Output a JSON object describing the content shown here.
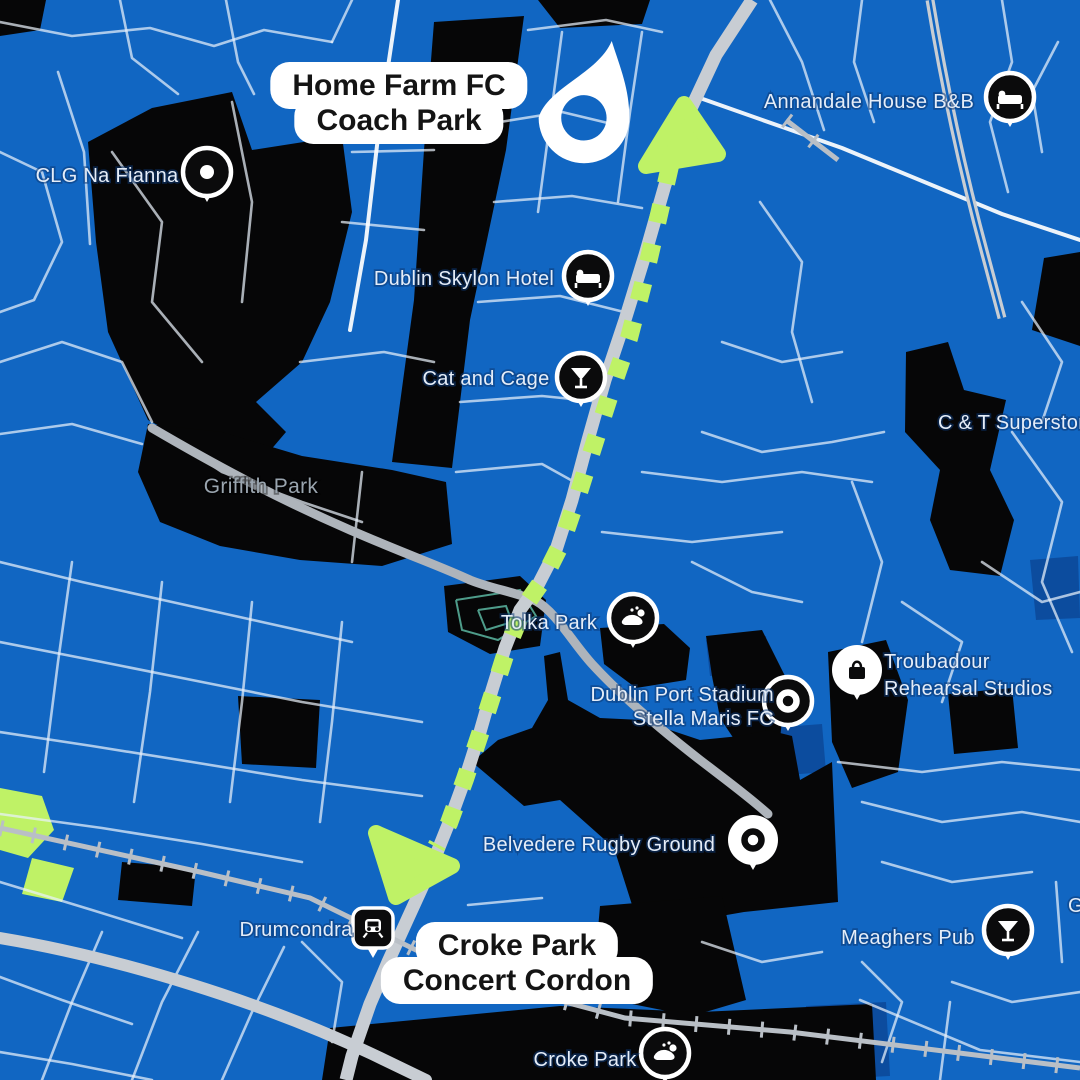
{
  "title": "Croke Park concert coach route map",
  "colors": {
    "background": "#1166C2",
    "land_black": "#060607",
    "building_navy": "#0C4C9E",
    "road_minor": "#E9F1FB",
    "road_major": "#C8CDD3",
    "river": "#AEB4BB",
    "railway": "#B9BFC6",
    "route_green": "#BFF266",
    "pitch_teal": "#4E9C8A",
    "poi_text": "#E5EDF8",
    "park_text": "#9AA5AF",
    "pill_background": "#FFFFFF",
    "pill_text": "#141414",
    "pin_dark": "#0B0B0C",
    "pin_ring": "#FFFFFF"
  },
  "overlays": {
    "start": {
      "line1": "Home Farm FC",
      "line2": "Coach Park"
    },
    "end": {
      "line1": "Croke Park",
      "line2": "Concert Cordon"
    },
    "drop_pin": "location-drop-pin"
  },
  "map": {
    "black_areas": [
      "0,0 46,0 40,30 0,36",
      "88,142 152,108 232,92 252,150 342,136 352,212 330,302 302,362 256,402 286,432 252,472 190,442 148,420 108,332 96,242",
      "148,424 222,432 302,456 392,470 446,482 452,544 382,566 300,560 220,546 160,522 138,472",
      "434,22 524,16 506,150 470,320 452,468 392,462 414,300 424,150",
      "538,0 650,0 642,24 560,28",
      "906,352 948,342 964,390 1006,400 990,470 1014,520 1000,576 950,570 930,520 940,470 905,432",
      "1044,258 1080,252 1080,346 1032,330",
      "444,586 520,576 546,600 540,646 490,654 448,632",
      "600,628 664,624 690,648 686,680 636,688 604,664",
      "706,636 762,630 786,678 780,740 748,760 720,718 712,676",
      "544,656 560,652 568,700 600,718 640,720 700,740 740,736 768,730 792,736 800,780 832,762 838,902 744,912 640,930 614,848 560,800 524,806 472,762 498,740 532,728 548,700",
      "600,906 722,896 746,1000 692,1016 622,1002 596,952",
      "330,1028 560,1006 700,1012 872,1004 876,1080 322,1080",
      "828,652 886,640 908,700 898,772 852,788 832,742",
      "122,862 196,868 192,906 118,900",
      "238,696 320,700 316,768 242,764",
      "948,694 1012,688 1018,748 954,754"
    ],
    "navy_buildings": [
      "770,728 822,724 826,772 774,776",
      "706,640 766,636 770,672 710,676",
      "806,1006 886,1002 890,1076 810,1080",
      "1030,560 1078,556 1080,618 1036,620"
    ],
    "green_patches": [
      "0,788 42,796 54,830 28,858 0,850",
      "32,858 74,868 62,902 22,894"
    ],
    "tolka_outline": [
      "456,600 520,590 536,616 498,640 462,630 456,600",
      "478,610 506,606 512,622 486,630 478,610"
    ],
    "minor_roads": [
      "0,22 72,36 150,28 214,46 264,30 332,42",
      "120,0 132,58 178,94",
      "226,0 238,62 254,94",
      "58,72 84,152 90,244",
      "0,152 42,172 62,242 34,300 0,312",
      "0,362 62,342 122,362 152,422",
      "0,434 72,424 142,444",
      "332,42 352,0",
      "352,152 434,150",
      "342,222 424,230",
      "300,362 384,352 434,362",
      "528,30 606,20 662,32",
      "500,122 562,112 612,124",
      "494,202 572,196 642,208",
      "478,302 560,296 624,312",
      "460,402 542,396 602,402",
      "562,32 550,122 538,212",
      "642,32 630,112 618,202",
      "456,472 542,464 578,484",
      "770,0 802,62 824,130",
      "862,0 854,62 874,122",
      "1002,0 1012,62 990,122 1008,192",
      "760,202 802,262 792,332 812,402",
      "1022,302 1062,362 1042,422",
      "722,342 782,362 842,352",
      "702,432 762,452 832,442 884,432",
      "1058,42 1032,92 1042,152",
      "642,472 722,482 802,472 872,482",
      "602,532 692,542 782,532",
      "852,482 882,562 862,642",
      "1012,432 1062,502 1042,582 1072,652",
      "902,602 962,642 942,702",
      "982,562 1042,602 1080,592",
      "692,562 752,592 802,602",
      "0,562 82,582 172,602 262,622 352,642",
      "0,642 102,662 202,682 302,702 422,722",
      "0,732 92,746 192,762 302,780 422,796",
      "0,814 102,828 202,844 302,862",
      "72,562 58,662 44,772",
      "162,582 150,692 134,802",
      "252,602 242,702 230,802",
      "342,622 332,722 320,822",
      "0,882 92,910 182,938",
      "42,1080 72,1002 102,932",
      "132,1080 162,1002 198,932",
      "222,1080 252,1012 284,947",
      "0,977 62,1000 132,1024",
      "0,1052 72,1064 152,1080",
      "302,942 342,982 332,1042",
      "838,762 922,772 1002,762 1080,770",
      "862,802 942,822 1022,812 1080,822",
      "882,862 952,882 1032,872",
      "1056,882 1062,962",
      "702,942 762,962 822,952",
      "862,962 902,1002 882,1062",
      "952,982 1012,1002 1080,992",
      "860,1000 980,1050 1080,1062",
      "950,1002 940,1080",
      "112,152 162,222 152,302 202,362",
      "232,102 252,202 242,302",
      "162,432 222,472 302,502 362,522",
      "362,472 352,562",
      "468,905 542,898"
    ],
    "bright_roads": [
      "700,98 842,148 1002,214 1080,240",
      "398,0 380,120 366,240 350,330"
    ],
    "major_road": "M752,0 L716,55 L688,115 L665,185 L645,255 L625,320 L605,380 L588,440 L572,500 L556,550 L538,585 L520,610 L505,648 L492,690 L480,732 L466,776 L450,820 L430,870 L408,918 L388,962 L370,1004 L352,1056 L346,1080",
    "motorway": "M930,0 C944,84 962,170 986,258 L1002,318",
    "belt_road": "M0,938 C120,958 262,1002 372,1054 L426,1080",
    "river": "M152,428 C210,462 272,496 350,530 C410,556 440,566 470,580 C492,589 516,592 536,601 C556,612 572,642 592,664 C614,688 646,718 700,760 C726,780 748,796 768,814",
    "railways": [
      "M0,828 L200,872 L310,898 L420,952 L520,990 L625,1018 L790,1032 L1080,1068",
      "M786,120 L838,160"
    ],
    "route": {
      "path": "M670,166 L656,228 L643,284 L629,338 L612,388 L596,438 L579,492 L562,542 L543,580 L524,607 L508,646 L494,690 L480,734 L465,779 L449,823 L436,847",
      "arrow_top": "M684,104 L646,166 L718,154 Z",
      "arrow_bottom": "M396,897 L376,833 L452,866 Z"
    },
    "pois": [
      {
        "id": "annandale-house-bb",
        "label": "Annandale House B&B",
        "anchor": "middle",
        "tx": 869,
        "ty": 108,
        "px": 1010,
        "py": 97,
        "icon": "bed",
        "style": "dark"
      },
      {
        "id": "clg-na-fianna",
        "label": "CLG Na Fianna",
        "anchor": "middle",
        "tx": 107,
        "ty": 182,
        "px": 207,
        "py": 172,
        "icon": "dot",
        "style": "dark"
      },
      {
        "id": "dublin-skylon-hotel",
        "label": "Dublin Skylon Hotel",
        "anchor": "middle",
        "tx": 464,
        "ty": 285,
        "px": 588,
        "py": 276,
        "icon": "bed",
        "style": "dark"
      },
      {
        "id": "cat-and-cage",
        "label": "Cat and Cage",
        "anchor": "middle",
        "tx": 486,
        "ty": 385,
        "px": 581,
        "py": 377,
        "icon": "martini",
        "style": "dark"
      },
      {
        "id": "griffith-park",
        "label": "Griffith Park",
        "anchor": "middle",
        "tx": 261,
        "ty": 493,
        "park": true
      },
      {
        "id": "c-and-t-superstore",
        "label": "C & T Superstore",
        "anchor": "start",
        "tx": 938,
        "ty": 429
      },
      {
        "id": "tolka-park",
        "label": "Tolka Park",
        "anchor": "middle",
        "tx": 549,
        "ty": 629,
        "px": 633,
        "py": 618,
        "icon": "stadium",
        "style": "dark"
      },
      {
        "id": "dublin-port-stadium",
        "label": "Dublin Port Stadium",
        "label2": "Stella Maris FC",
        "anchor": "end",
        "tx": 774,
        "ty": 701,
        "ty2": 725,
        "px": 788,
        "py": 701,
        "icon": "donut",
        "style": "dark"
      },
      {
        "id": "troubadour-rehearsal-studios",
        "label": "Troubadour",
        "label2": "Rehearsal Studios",
        "anchor": "start",
        "tx": 884,
        "ty": 668,
        "ty2": 695,
        "px": 857,
        "py": 670,
        "icon": "bag",
        "style": "light"
      },
      {
        "id": "belvedere-rugby-ground",
        "label": "Belvedere Rugby Ground",
        "anchor": "middle",
        "tx": 599,
        "ty": 851,
        "px": 753,
        "py": 840,
        "icon": "donut",
        "style": "light"
      },
      {
        "id": "drumcondra-station",
        "label": "Drumcondra",
        "anchor": "middle",
        "tx": 296,
        "ty": 936,
        "px": 373,
        "py": 928,
        "icon": "train",
        "style": "station"
      },
      {
        "id": "meaghers-pub",
        "label": "Meaghers Pub",
        "anchor": "middle",
        "tx": 908,
        "ty": 944,
        "px": 1008,
        "py": 930,
        "icon": "martini",
        "style": "dark"
      },
      {
        "id": "croke-park",
        "label": "Croke Park",
        "anchor": "middle",
        "tx": 585,
        "ty": 1066,
        "px": 665,
        "py": 1053,
        "icon": "stadium",
        "style": "dark"
      },
      {
        "id": "clipped-label-g",
        "label": "G",
        "anchor": "start",
        "tx": 1068,
        "ty": 912
      }
    ]
  }
}
